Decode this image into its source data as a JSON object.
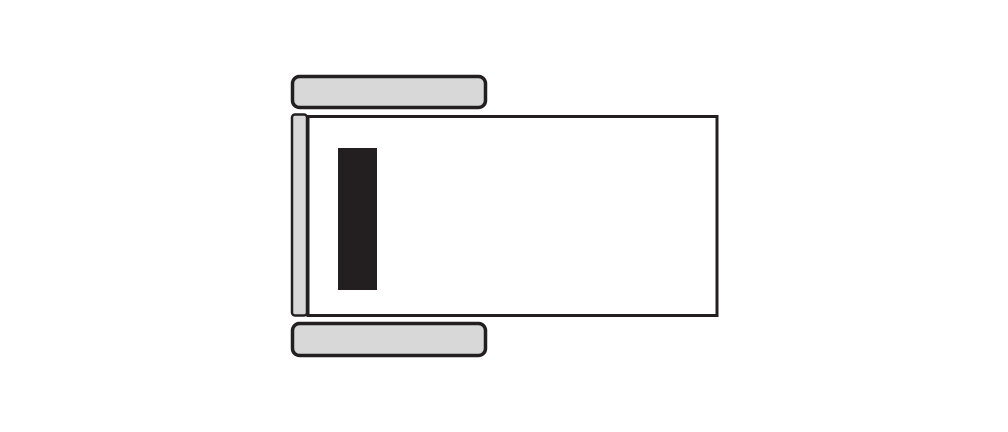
{
  "diagram": {
    "name": "equipment-top-view-schematic",
    "colors": {
      "background": "#ffffff",
      "outline": "#231f20",
      "light_fill": "#d8d8d8",
      "body_fill": "#ffffff",
      "slot_fill": "#231f20"
    },
    "parts": {
      "top_wheel": "top-wheel",
      "bottom_wheel": "bottom-wheel",
      "side_rail": "side-rail",
      "main_body": "main-body",
      "dark_slot": "dark-slot"
    }
  }
}
